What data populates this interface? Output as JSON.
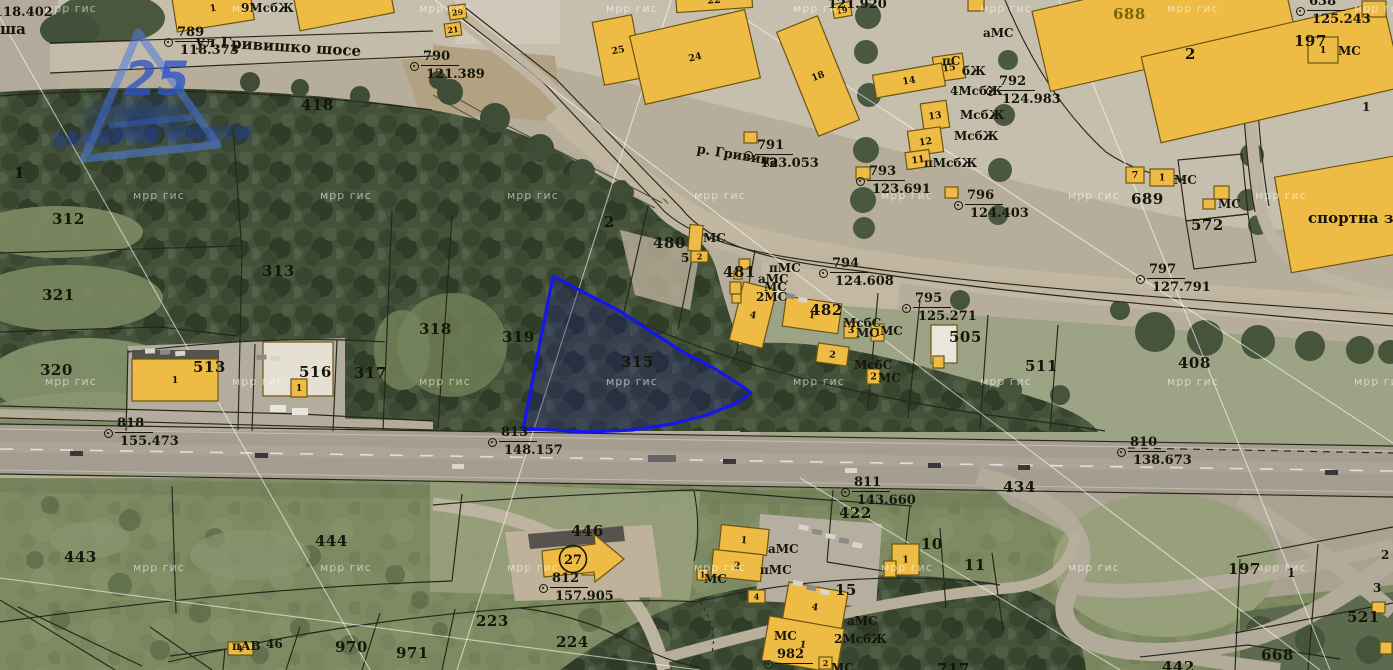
{
  "meta": {
    "width": 1393,
    "height": 670,
    "description": "cadastral GIS map over orthophoto, parcel 315 highlighted"
  },
  "colors": {
    "building_fill": "#eebc45",
    "building_stroke": "#6b5512",
    "parcel_line": "#26261a",
    "highlight_blue": "#1515f0",
    "label_color": "#15150a",
    "watermark_blue": "#4d7ade"
  },
  "logo": {
    "number": "25",
    "wordmark": "ЗАХАРОВ ИМОТИ"
  },
  "special": {
    "circled27": "27"
  },
  "watermark": {
    "tile_text": "мрр гис",
    "rows": [
      {
        "y": 2,
        "x0": 45
      },
      {
        "y": 189,
        "x0": 133
      },
      {
        "y": 375,
        "x0": 45
      },
      {
        "y": 561,
        "x0": 133
      }
    ],
    "dx": 187
  },
  "labels": {
    "street": {
      "t": "ул.Гривишко шосе",
      "x": 196,
      "y": 32,
      "r": 3.5,
      "cls": "street"
    },
    "river": {
      "t": "р. Гривица",
      "x": 698,
      "y": 142,
      "r": 9,
      "cls": "river"
    },
    "sports_hall": {
      "t": "спортна зала М",
      "x": 1308,
      "y": 209,
      "r": 0,
      "cls": "place"
    },
    "fragments": [
      {
        "t": "118.402",
        "x": -6,
        "y": 5,
        "r": 0,
        "cls": "elev"
      },
      {
        "t": "ша",
        "x": 0,
        "y": 20,
        "r": 0,
        "cls": "street"
      },
      {
        "t": "121.920",
        "x": 828,
        "y": -3,
        "r": 0,
        "cls": "elev"
      }
    ]
  },
  "parcel_labels": [
    [
      "312",
      52,
      210
    ],
    [
      "321",
      42,
      286
    ],
    [
      "313",
      262,
      262
    ],
    [
      "320",
      40,
      361
    ],
    [
      "318",
      419,
      320
    ],
    [
      "319",
      502,
      328
    ],
    [
      "315",
      621,
      353
    ],
    [
      "317",
      354,
      364
    ],
    [
      "516",
      299,
      363
    ],
    [
      "513",
      193,
      358
    ],
    [
      "480",
      653,
      234
    ],
    [
      "481",
      723,
      263
    ],
    [
      "482",
      810,
      301
    ],
    [
      "505",
      949,
      328
    ],
    [
      "511",
      1025,
      357
    ],
    [
      "408",
      1178,
      354
    ],
    [
      "418",
      301,
      96
    ],
    [
      "2",
      604,
      213
    ],
    [
      "688",
      1113,
      5,
      "#7c6604"
    ],
    [
      "689",
      1131,
      190
    ],
    [
      "572",
      1191,
      216
    ],
    [
      "197",
      1294,
      32
    ],
    [
      "2",
      1185,
      45
    ],
    [
      "434",
      1003,
      478
    ],
    [
      "422",
      839,
      504
    ],
    [
      "443",
      64,
      548
    ],
    [
      "444",
      315,
      532
    ],
    [
      "446",
      571,
      522
    ],
    [
      "10",
      921,
      535
    ],
    [
      "11",
      964,
      556
    ],
    [
      "15",
      835,
      581
    ],
    [
      "970",
      335,
      638
    ],
    [
      "971",
      396,
      644
    ],
    [
      "223",
      476,
      612
    ],
    [
      "224",
      556,
      633
    ],
    [
      "717",
      937,
      660
    ],
    [
      "442",
      1162,
      658
    ],
    [
      "521",
      1347,
      608
    ],
    [
      "668",
      1261,
      646
    ],
    [
      "197",
      1228,
      560
    ],
    [
      "1",
      1287,
      566,
      null,
      12
    ],
    [
      "2",
      1381,
      548,
      null,
      12
    ],
    [
      "3",
      1373,
      581,
      null,
      12
    ],
    [
      "1",
      14,
      164
    ]
  ],
  "code_labels": [
    [
      "9МсбЖ",
      241,
      1
    ],
    [
      "аМС",
      983,
      26
    ],
    [
      "пС",
      942,
      54
    ],
    [
      "бЖ",
      962,
      64
    ],
    [
      "4МсбЖ",
      950,
      84
    ],
    [
      "МсбЖ",
      960,
      108
    ],
    [
      "МсбЖ",
      954,
      129
    ],
    [
      "пМсбЖ",
      924,
      156
    ],
    [
      "МС",
      1174,
      173
    ],
    [
      "МС",
      1218,
      197
    ],
    [
      "МС",
      1338,
      44
    ],
    [
      "1",
      1362,
      100
    ],
    [
      "МС",
      703,
      231
    ],
    [
      "5",
      681,
      251
    ],
    [
      "пМС",
      769,
      261
    ],
    [
      "аМС",
      758,
      272
    ],
    [
      "МС",
      764,
      280
    ],
    [
      "2МС",
      756,
      290
    ],
    [
      "МсбС",
      843,
      316
    ],
    [
      "МС",
      856,
      326
    ],
    [
      "МС",
      880,
      324
    ],
    [
      "МсбС",
      854,
      358
    ],
    [
      "МС",
      878,
      371
    ],
    [
      "аМС",
      768,
      542
    ],
    [
      "пМС",
      760,
      563
    ],
    [
      "МС",
      704,
      572
    ],
    [
      "аМС",
      847,
      614
    ],
    [
      "2МсбЖ",
      834,
      632
    ],
    [
      "МС",
      774,
      629
    ],
    [
      "МС",
      831,
      661
    ],
    [
      "пАВ",
      232,
      639
    ],
    [
      "46",
      266,
      637
    ]
  ],
  "survey_points": [
    [
      "789",
      "118.373",
      168,
      42
    ],
    [
      "790",
      "121.389",
      414,
      66
    ],
    [
      "791",
      "123.053",
      748,
      155
    ],
    [
      "792",
      "124.983",
      990,
      91
    ],
    [
      "793",
      "123.691",
      860,
      181
    ],
    [
      "794",
      "124.608",
      823,
      273
    ],
    [
      "795",
      "125.271",
      906,
      308
    ],
    [
      "796",
      "124.403",
      958,
      205
    ],
    [
      "797",
      "127.791",
      1140,
      279
    ],
    [
      "810",
      "138.673",
      1121,
      452
    ],
    [
      "811",
      "143.660",
      845,
      492
    ],
    [
      "812",
      "157.905",
      543,
      588
    ],
    [
      "813",
      "148.157",
      492,
      442
    ],
    [
      "818",
      "155.473",
      108,
      433
    ],
    [
      "982",
      "",
      768,
      664
    ],
    [
      "638",
      "125.243",
      1300,
      11
    ]
  ],
  "buildings": [
    [
      174,
      -10,
      78,
      36,
      -9,
      "1"
    ],
    [
      296,
      -12,
      96,
      34,
      -11,
      ""
    ],
    [
      449,
      5,
      17,
      14,
      -8,
      "29"
    ],
    [
      445,
      23,
      16,
      13,
      -8,
      "21"
    ],
    [
      598,
      18,
      40,
      64,
      -11,
      "25"
    ],
    [
      636,
      22,
      118,
      70,
      -13,
      "24"
    ],
    [
      676,
      -10,
      76,
      20,
      -4,
      "22"
    ],
    [
      1038,
      -18,
      252,
      82,
      -13,
      ""
    ],
    [
      1148,
      28,
      248,
      88,
      -13,
      ""
    ],
    [
      1282,
      165,
      132,
      97,
      -10,
      ""
    ],
    [
      796,
      20,
      44,
      112,
      -22,
      "18"
    ],
    [
      833,
      3,
      18,
      14,
      -10,
      "19"
    ],
    [
      934,
      55,
      30,
      25,
      -8,
      "15"
    ],
    [
      874,
      69,
      70,
      23,
      -10,
      "14"
    ],
    [
      922,
      102,
      26,
      27,
      -8,
      "13"
    ],
    [
      909,
      129,
      33,
      25,
      -8,
      "12"
    ],
    [
      906,
      151,
      24,
      17,
      -8,
      "11"
    ],
    [
      856,
      167,
      14,
      12,
      0,
      ""
    ],
    [
      968,
      -2,
      16,
      13,
      0,
      ""
    ],
    [
      945,
      187,
      13,
      11,
      0,
      ""
    ],
    [
      744,
      132,
      13,
      11,
      0,
      ""
    ],
    [
      1126,
      167,
      18,
      16,
      0,
      "7"
    ],
    [
      1150,
      169,
      24,
      17,
      0,
      "1"
    ],
    [
      1214,
      186,
      15,
      13,
      0,
      ""
    ],
    [
      1203,
      199,
      12,
      10,
      0,
      ""
    ],
    [
      1308,
      37,
      30,
      26,
      0,
      "1"
    ],
    [
      1362,
      1,
      24,
      16,
      0,
      ""
    ],
    [
      132,
      359,
      86,
      42,
      0,
      "1"
    ],
    [
      263,
      342,
      70,
      54,
      0,
      "",
      "#e5e0d3"
    ],
    [
      291,
      379,
      16,
      18,
      0,
      "1"
    ],
    [
      931,
      325,
      26,
      38,
      0,
      "",
      "#eae6db"
    ],
    [
      933,
      356,
      11,
      12,
      0,
      ""
    ],
    [
      689,
      225,
      13,
      26,
      5,
      ""
    ],
    [
      691,
      251,
      17,
      11,
      0,
      "2"
    ],
    [
      736,
      285,
      34,
      60,
      14,
      "4"
    ],
    [
      739,
      259,
      11,
      10,
      0,
      ""
    ],
    [
      734,
      271,
      8,
      8,
      0,
      ""
    ],
    [
      730,
      282,
      11,
      12,
      0,
      ""
    ],
    [
      732,
      294,
      9,
      9,
      0,
      ""
    ],
    [
      784,
      300,
      56,
      30,
      8,
      "1"
    ],
    [
      844,
      322,
      14,
      16,
      0,
      "3"
    ],
    [
      871,
      324,
      13,
      17,
      0,
      "1"
    ],
    [
      817,
      345,
      31,
      19,
      8,
      "2"
    ],
    [
      867,
      369,
      13,
      15,
      0,
      "2"
    ],
    [
      582,
      564,
      21,
      11,
      0,
      "2"
    ],
    [
      720,
      527,
      48,
      26,
      6,
      "1"
    ],
    [
      712,
      552,
      50,
      27,
      6,
      "2"
    ],
    [
      697,
      569,
      11,
      11,
      0,
      "1"
    ],
    [
      748,
      590,
      17,
      13,
      0,
      "4"
    ],
    [
      785,
      587,
      60,
      40,
      10,
      "4"
    ],
    [
      765,
      622,
      76,
      45,
      10,
      "1"
    ],
    [
      819,
      657,
      13,
      12,
      0,
      "2"
    ],
    [
      892,
      544,
      27,
      31,
      0,
      "1"
    ],
    [
      884,
      561,
      12,
      16,
      0,
      ""
    ],
    [
      228,
      642,
      25,
      13,
      0,
      "1"
    ],
    [
      1372,
      602,
      13,
      11,
      0,
      ""
    ],
    [
      1380,
      642,
      12,
      12,
      0,
      ""
    ]
  ]
}
